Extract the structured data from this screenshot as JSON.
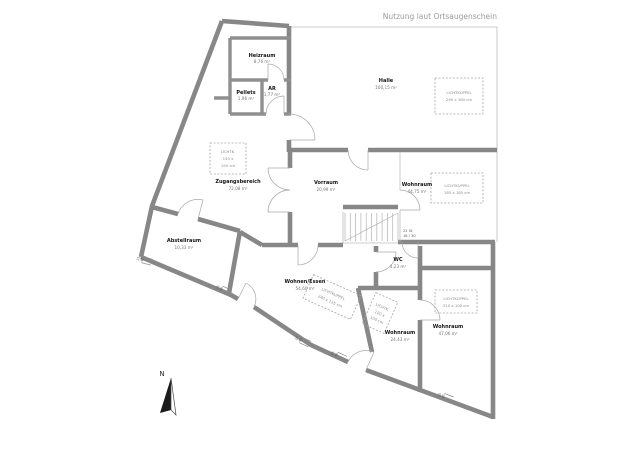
{
  "header": {
    "annotation": "Nutzung laut Ortsaugenschein"
  },
  "rooms": {
    "heizraum": {
      "name": "Heizraum",
      "area": "8,76 m²"
    },
    "pellets": {
      "name": "Pellets",
      "area": "1,96 m²"
    },
    "ar": {
      "name": "AR",
      "area": "1,77 m²"
    },
    "halle": {
      "name": "Halle",
      "area": "100,15 m²"
    },
    "zugangsbereich": {
      "name": "Zugangsbereich",
      "area": "72,08 m²"
    },
    "vorraum": {
      "name": "Vorraum",
      "area": "20,99 m²"
    },
    "wohnraum_mitte": {
      "name": "Wohnraum",
      "area": "44,75 m²"
    },
    "abstellraum": {
      "name": "Abstellraum",
      "area": "10,33 m²"
    },
    "wohnen_essen": {
      "name": "Wohnen/Essen",
      "area": "54,60 m²"
    },
    "wc": {
      "name": "WC",
      "area": "4,23 m²"
    },
    "wohnraum_sued": {
      "name": "Wohnraum",
      "area": "24,43 m²"
    },
    "wohnraum_ost": {
      "name": "Wohnraum",
      "area": "47,06 m²"
    }
  },
  "skylights": {
    "halle": {
      "lines": [
        "LICHTKUPPEL",
        "295 x 180 cm"
      ]
    },
    "zugang": {
      "lines": [
        "LICHTK.",
        "150 x",
        "150 cm"
      ]
    },
    "mitte": {
      "lines": [
        "LICHTKUPPEL",
        "185 x 185 cm"
      ]
    },
    "essen": {
      "lines": [
        "LICHTKUPPEL",
        "240 x 115 cm"
      ]
    },
    "klein": {
      "lines": [
        "LICHTK.",
        "100 x",
        "100 cm"
      ]
    },
    "ost": {
      "lines": [
        "LICHTKUPPEL",
        "310 x 100 cm"
      ]
    }
  },
  "stairs": {
    "line1": "22 St",
    "line2": "18 / 30"
  },
  "dimension_mark": {
    "upper": "25",
    "lower": "40"
  },
  "compass": {
    "label": "N"
  },
  "colors": {
    "wall": "#878787",
    "thin_line": "#bcbcbc",
    "dashed": "#a5a5a5",
    "label": "#151515",
    "muted": "#767676"
  }
}
